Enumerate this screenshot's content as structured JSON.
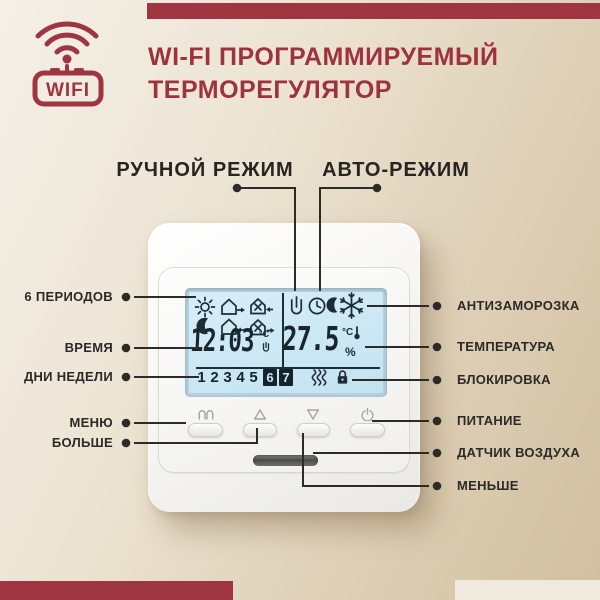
{
  "header": {
    "badge_text": "WIFI",
    "title_line1": "WI-FI ПРОГРАММИРУЕМЫЙ",
    "title_line2": "ТЕРМОРЕГУЛЯТОР"
  },
  "modes": {
    "manual": "РУЧНОЙ РЕЖИМ",
    "auto": "АВТО-РЕЖИМ"
  },
  "callouts": {
    "left": [
      "6 ПЕРИОДОВ",
      "ВРЕМЯ",
      "ДНИ НЕДЕЛИ",
      "МЕНЮ",
      "БОЛЬШЕ"
    ],
    "right": [
      "АНТИЗАМОРОЗКА",
      "ТЕМПЕРАТУРА",
      "БЛОКИРОВКА",
      "ПИТАНИЕ",
      "ДАТЧИК ВОЗДУХА",
      "МЕНЬШЕ"
    ]
  },
  "display": {
    "time": "12:03",
    "time_unit": "°C",
    "temperature": "27.5",
    "temp_unit": "°C",
    "percent": "%",
    "days": [
      "1",
      "2",
      "3",
      "4",
      "5"
    ],
    "days_inverted": [
      "6",
      "7"
    ]
  },
  "device_buttons": [
    "menu-book",
    "arrow-up",
    "arrow-down",
    "power"
  ],
  "icons": [
    "wifi-icon",
    "sun-icon",
    "moon-icon",
    "house-leave-icon",
    "house-dinner-return-icon",
    "house-return-icon",
    "house-dinner-leave-icon",
    "hand-manual-icon",
    "clock-auto-icon",
    "snowflake-icon",
    "heat-waves-icon",
    "lock-icon",
    "menu-book-icon",
    "arrow-up-icon",
    "arrow-down-icon",
    "power-icon",
    "thermometer-icon"
  ],
  "colors": {
    "accent_red": "#9E3540",
    "lcd_blue": "#C9E5F3",
    "label_dark": "#2B2A27",
    "background_light": "#F4F0E8",
    "background_tan": "#D0BF9F"
  }
}
